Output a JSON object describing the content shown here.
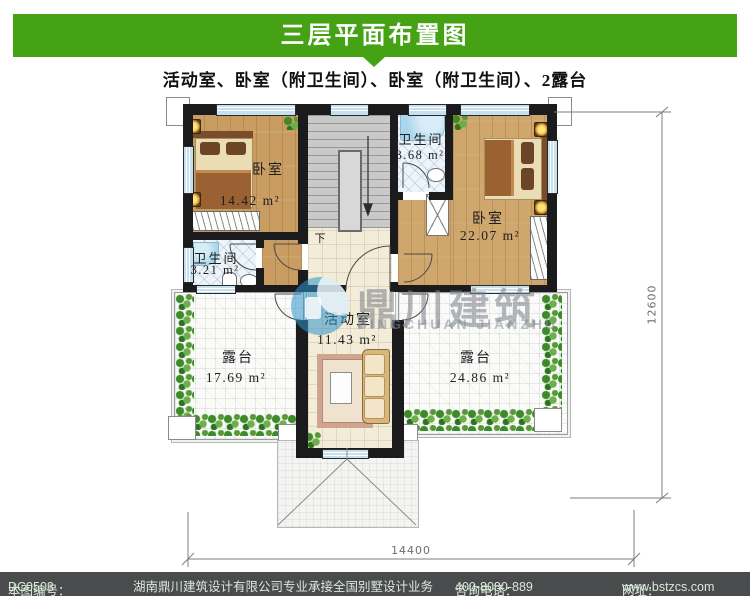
{
  "header": {
    "title": "三层平面布置图",
    "bg_color": "#45a214"
  },
  "subtitle": "活动室、卧室（附卫生间）、卧室（附卫生间）、2露台",
  "plan": {
    "rooms": {
      "bedroom_left": {
        "name": "卧室",
        "area": "14.42 m²"
      },
      "bath_top": {
        "name": "卫生间",
        "area": "3.68 m²"
      },
      "bedroom_right": {
        "name": "卧室",
        "area": "22.07 m²"
      },
      "bath_bottom": {
        "name": "卫生间",
        "area": "3.21 m²"
      },
      "activity": {
        "name": "活动室",
        "area": "11.43 m²"
      },
      "terrace_left": {
        "name": "露台",
        "area": "17.69 m²"
      },
      "terrace_right": {
        "name": "露台",
        "area": "24.86 m²"
      }
    },
    "stair_down_label": "下",
    "dimensions": {
      "bottom": "14400",
      "right": "12600"
    }
  },
  "watermark": {
    "cn": "鼎川建筑",
    "en": "DINGCHUAN JIANZHU",
    "logo_color": "#2f94cb"
  },
  "footer": {
    "bg_color": "#4a4b4d",
    "text_color": "#d9e9d9",
    "number_label": "本图编号：",
    "number": "DC0503",
    "company": "湖南鼎川建筑设计有限公司专业承接全国别墅设计业务",
    "phone_label": "咨询电话：",
    "phone": "400-8080-889",
    "site_label": "网址：",
    "site": "www.bstzcs.com"
  }
}
